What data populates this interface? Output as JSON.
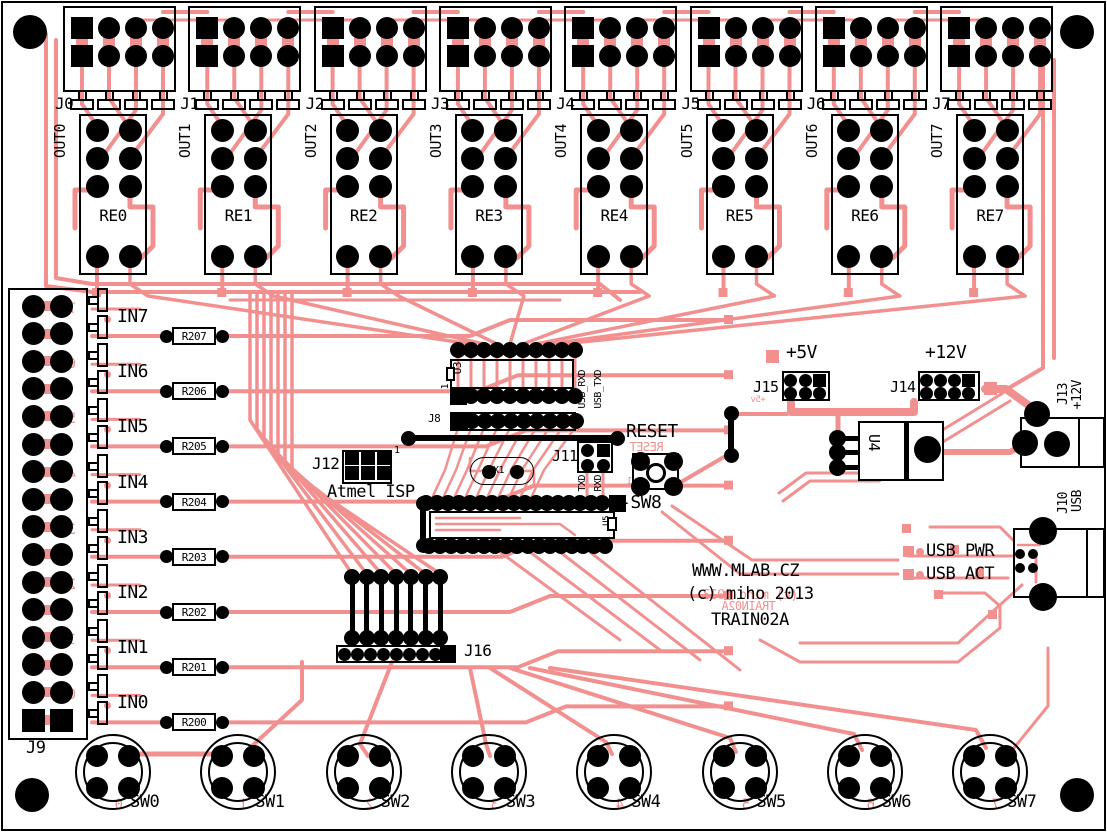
{
  "colors": {
    "copper": "#f29090",
    "silkscreen": "#000000",
    "board": "#ffffff"
  },
  "top_connectors": [
    "J0",
    "J1",
    "J2",
    "J3",
    "J4",
    "J5",
    "J6",
    "J7"
  ],
  "relays": [
    {
      "name": "RE0",
      "out": "OUT0"
    },
    {
      "name": "RE1",
      "out": "OUT1"
    },
    {
      "name": "RE2",
      "out": "OUT2"
    },
    {
      "name": "RE3",
      "out": "OUT3"
    },
    {
      "name": "RE4",
      "out": "OUT4"
    },
    {
      "name": "RE5",
      "out": "OUT5"
    },
    {
      "name": "RE6",
      "out": "OUT6"
    },
    {
      "name": "RE7",
      "out": "OUT7"
    }
  ],
  "inputs": [
    {
      "name": "IN7",
      "resistor": "R207"
    },
    {
      "name": "IN6",
      "resistor": "R206"
    },
    {
      "name": "IN5",
      "resistor": "R205"
    },
    {
      "name": "IN4",
      "resistor": "R204"
    },
    {
      "name": "IN3",
      "resistor": "R203"
    },
    {
      "name": "IN2",
      "resistor": "R202"
    },
    {
      "name": "IN1",
      "resistor": "R201"
    },
    {
      "name": "IN0",
      "resistor": "R200"
    }
  ],
  "input_connector": "J9",
  "j9_mirror_digits": [
    "7",
    "6",
    "5",
    "4",
    "3",
    "2",
    "1",
    "0"
  ],
  "switches": [
    "SW0",
    "SW1",
    "SW2",
    "SW3",
    "SW4",
    "SW5",
    "SW6",
    "SW7"
  ],
  "sw_mirror_digits": [
    "0",
    "1",
    "2",
    "3",
    "4",
    "5",
    "6",
    "7"
  ],
  "jumper_block": "J16",
  "isp": {
    "ref": "J12",
    "pin1": "1",
    "name": "Atmel ISP"
  },
  "u3": {
    "ref": "U3",
    "pin1": "1"
  },
  "j8": {
    "ref": "J8"
  },
  "serial": {
    "ref": "J11",
    "top_labels": [
      "USB_RXD",
      "USB_TXD"
    ],
    "bottom_labels": [
      "TXD",
      "RXD"
    ]
  },
  "crystal": {
    "ref": "X1"
  },
  "reset": {
    "label": "RESET",
    "mirror": "RESET",
    "button": "-SW8",
    "pin1": "1"
  },
  "mcu": {
    "ref": "U5"
  },
  "power": {
    "v5_label": "+5V",
    "v5_ref": "J15",
    "v5_mirror": "+5v",
    "v12_label": "+12V",
    "v12_ref": "J14",
    "regulator": "U4"
  },
  "jack": {
    "ref": "J13",
    "label": "+12V"
  },
  "usb": {
    "ref": "J10",
    "label": "USB",
    "led_pwr": "USB PWR",
    "led_act": "USB ACT"
  },
  "legend": {
    "website": "WWW.MLAB.CZ",
    "copyright": "(c) miho 2013",
    "name": "TRAIN02A",
    "mirror_copyright": "(c) miho 2013",
    "mirror_name": "TRAIN02A"
  }
}
